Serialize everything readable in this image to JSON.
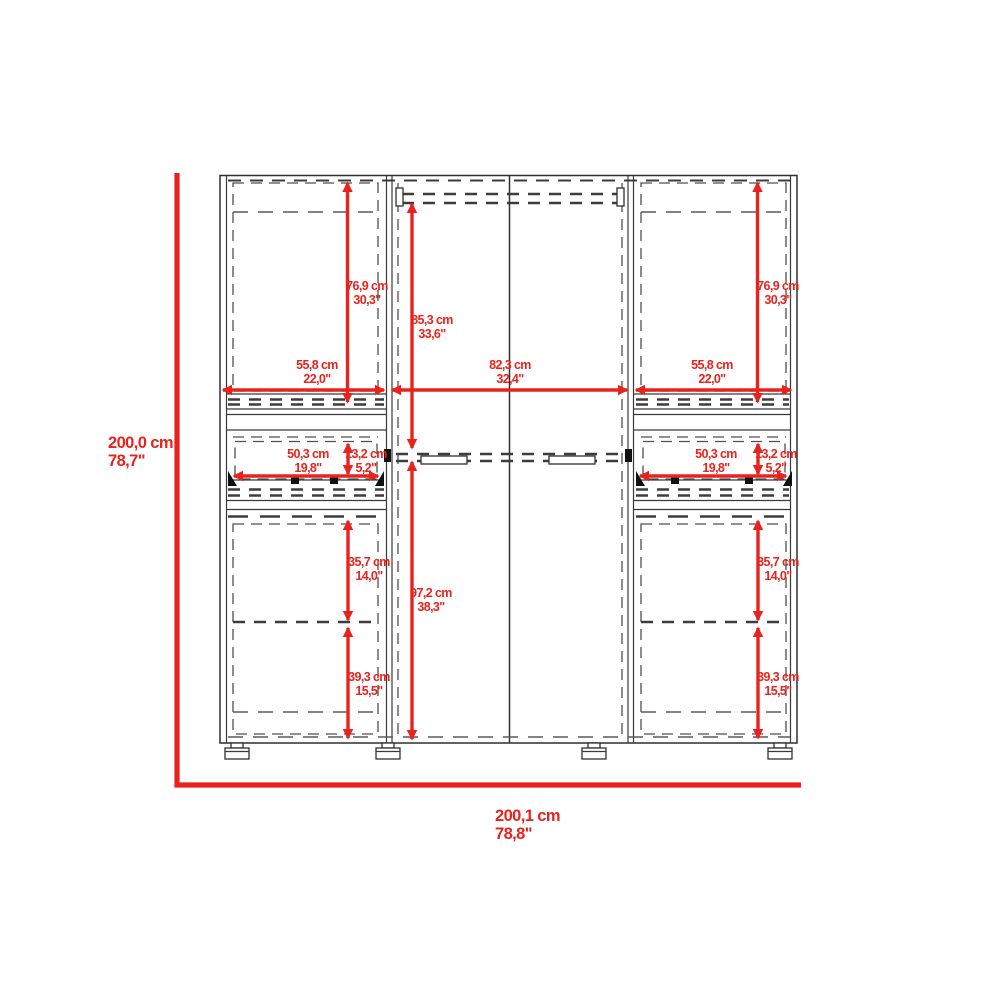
{
  "diagram": {
    "type": "wardrobe-dimension-drawing",
    "accent_color": "#e8231d",
    "line_color": "#2f2f2f",
    "background_color": "#ffffff"
  },
  "dimensions": {
    "overall_height": {
      "cm": "200,0 cm",
      "in": "78,7\""
    },
    "overall_width": {
      "cm": "200,1 cm",
      "in": "78,8\""
    },
    "side_door_height": {
      "cm": "76,9 cm",
      "in": "30,3\""
    },
    "side_width": {
      "cm": "55,8 cm",
      "in": "22,0\""
    },
    "center_upper_height": {
      "cm": "85,3 cm",
      "in": "33,6\""
    },
    "center_width": {
      "cm": "82,3 cm",
      "in": "32,4\""
    },
    "center_lower_height": {
      "cm": "97,2 cm",
      "in": "38,3\""
    },
    "drawer_width": {
      "cm": "50,3 cm",
      "in": "19,8\""
    },
    "drawer_height": {
      "cm": "13,2 cm",
      "in": "5,2\""
    },
    "upper_shelf_spacing": {
      "cm": "35,7 cm",
      "in": "14,0\""
    },
    "lower_shelf_spacing": {
      "cm": "39,3 cm",
      "in": "15,5\""
    }
  }
}
